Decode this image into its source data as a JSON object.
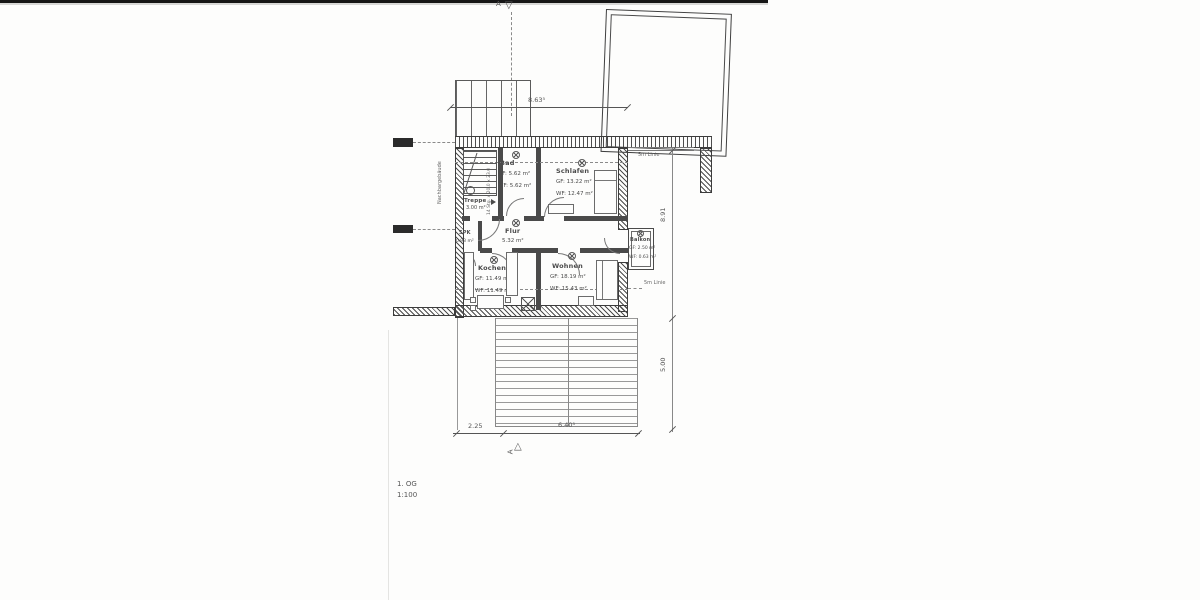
{
  "plan": {
    "floor_label": "1. OG",
    "scale_label": "1:100",
    "neighbor_label": "Nachbargebäude",
    "section_letter": "A",
    "line_5m_top": "5m Linie",
    "line_5m_bottom": "5m Linie",
    "stair_note": "14 Stg. x 20.0 x 23.0"
  },
  "rooms": {
    "treppe": {
      "name": "Treppe",
      "area": "3.00 m²"
    },
    "spk": {
      "name": "SPK",
      "area": "0.93 m²"
    },
    "bad": {
      "name": "Bad",
      "gf": "GF: 5.62 m²",
      "wf": "WF: 5.62 m²"
    },
    "schlafen": {
      "name": "Schlafen",
      "gf": "GF: 13.22 m²",
      "wf": "WF: 12.47 m²"
    },
    "flur": {
      "name": "Flur",
      "area": "5.32 m²"
    },
    "kochen": {
      "name": "Kochen",
      "gf": "GF: 11.49 m²",
      "wf": "WF: 11.49 m²"
    },
    "wohnen": {
      "name": "Wohnen",
      "gf": "GF: 18.19 m²",
      "wf": "WF: 15.43 m²"
    },
    "balkon": {
      "name": "Balkon",
      "gf": "GF: 2.50 m²",
      "wf": "WF: 0.63 m²"
    }
  },
  "dimensions": {
    "top_width": "8.63⁵",
    "bottom_left": "2.25",
    "bottom_right": "6.40⁵",
    "right_upper": "8.91",
    "right_lower": "5.00"
  },
  "colors": {
    "ink": "#3f3f3f",
    "paper": "#fdfdfc"
  }
}
